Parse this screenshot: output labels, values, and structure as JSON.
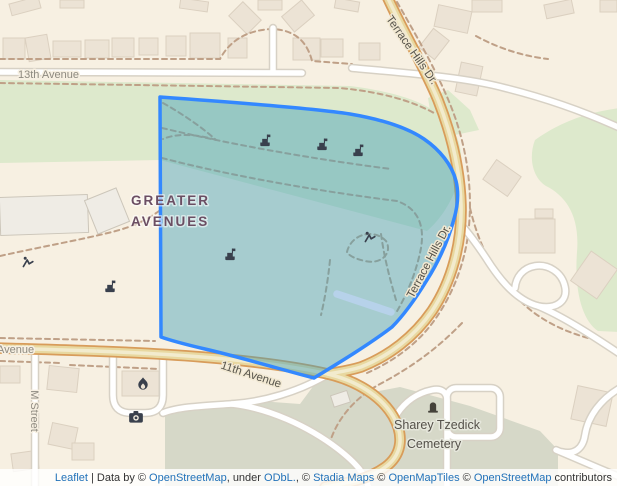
{
  "map": {
    "neighborhood_label": {
      "line1": "GREATER",
      "line2": "AVENUES"
    },
    "road_labels": {
      "thirteenth_avenue": "13th Avenue",
      "eleventh_avenue": "11th Avenue",
      "avenue_partial": "Avenue",
      "m_street": "M Street",
      "terrace_hills_top": "Terrace Hills Dr.",
      "terrace_hills_mid": "Terrace Hills Dr."
    },
    "poi_labels": {
      "cemetery_name": "Sharey Tzedick",
      "cemetery_type": "Cemetery"
    },
    "icons": [
      "shelter-icon",
      "playground-icon",
      "fire-station-icon",
      "camera-icon",
      "cemetery-icon"
    ],
    "colors": {
      "land": "#f7f0e2",
      "greenspace": "#dde9cc",
      "scrub": "#d6d8c8",
      "building": "#ece3d5",
      "road_minor": "#ffffff",
      "road_major_fill": "#e8d8a0",
      "road_major_casing": "#d89c5a",
      "trail": "#bfa087",
      "water": "#b7d2ea",
      "polygon_stroke": "#3388ff",
      "polygon_fill": "rgba(67,160,184,0.45)",
      "poi_icon": "#39404d",
      "place_label": "#6b4e63",
      "attribution_link": "#2272b9"
    }
  },
  "attribution": {
    "leaflet": "Leaflet",
    "sep_databy": " | Data by © ",
    "osm_link_1": "OpenStreetMap",
    "under_txt": ", under ",
    "odbl_link": "ODbL.",
    "comma_copy": ", © ",
    "stadia_link": "Stadia Maps",
    "copy_1": " © ",
    "openmaptiles_link": "OpenMapTiles",
    "copy_2": " © ",
    "osm_link_2": "OpenStreetMap",
    "contributors_txt": " contributors"
  }
}
